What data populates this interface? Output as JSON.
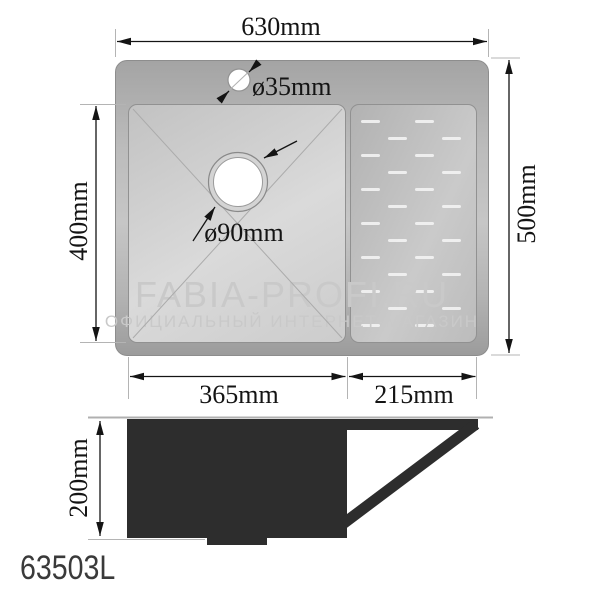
{
  "model_label": "63503L",
  "watermark": {
    "line1": "FABIA-PROFI.RU",
    "line2": "ОФИЦИАЛЬНЫЙ ИНТЕРНЕТ-МАГАЗИН"
  },
  "top_view": {
    "overall_width_label": "630mm",
    "overall_depth_label": "500mm",
    "bowl_height_label": "400mm",
    "bowl_width_label": "365mm",
    "drainboard_width_label": "215mm",
    "faucet_hole_label": "ø35mm",
    "drain_hole_label": "ø90mm"
  },
  "side_view": {
    "bowl_depth_label": "200mm"
  },
  "colors": {
    "dimension_ink": "#141414",
    "extension_line": "#b4b4b4",
    "steel_frame": "#a8a8a8",
    "bowl_surface": "#d4d4d4",
    "drainboard_surface": "#c0c0c0",
    "rib_highlight": "#f0f0f0",
    "side_profile": "#2d2d2d",
    "watermark": "#c9c9c9",
    "hole_fill": "#ffffff"
  },
  "ribs": {
    "col_x": [
      10,
      37,
      64,
      91
    ],
    "dash_width": 19,
    "dash_height": 3,
    "row_step": 34,
    "primary_rows": {
      "count": 7,
      "start_y": 15
    },
    "offset_rows": {
      "count": 6,
      "start_y": 32
    }
  }
}
